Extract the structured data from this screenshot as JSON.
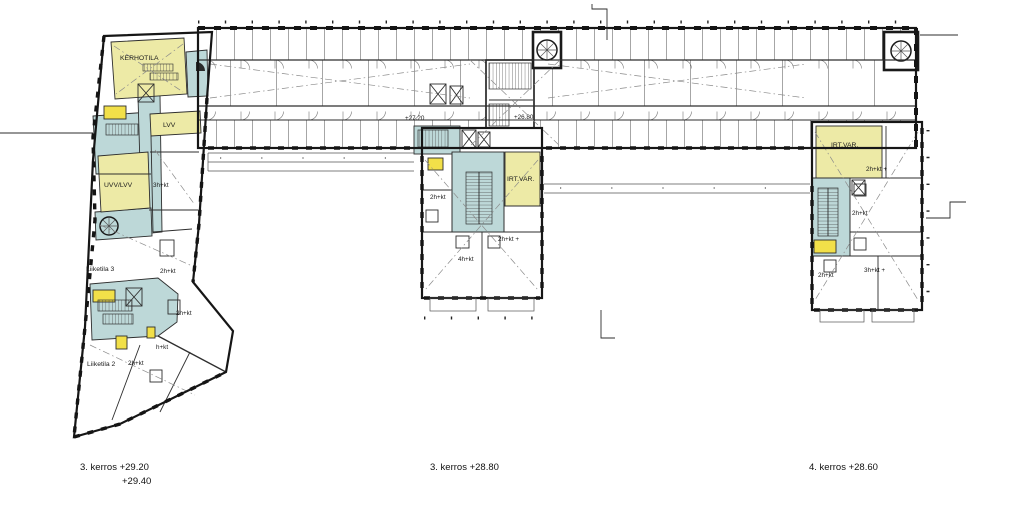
{
  "colors": {
    "paper": "#ffffff",
    "wall": "#161616",
    "thin_line": "#555555",
    "room_yellow": "#edeaa6",
    "room_blue": "#bdd8d8",
    "accent_yellow": "#f2e049"
  },
  "band": {
    "level_left": "+27.20",
    "level_right": "+26.80"
  },
  "left_wing": {
    "kerhotila": "KERHOTILA",
    "lvv": "LVV",
    "uvv_lvv": "UVV/LVV",
    "apt_3hkt": "3h+kt",
    "liiketila3": "Liiketila 3",
    "apt_2hkt_a": "2h+kt",
    "apt_2hkt_b": "2h+kt",
    "liiketila2": "Liiketila 2",
    "apt_2hkt_c": "2h+kt",
    "apt_hkt": "h+kt"
  },
  "middle_tower": {
    "irtvar": "IRT.VAR.",
    "apt_2hkt": "2h+kt",
    "apt_2hkt_plus": "2h+kt +",
    "apt_4hkt": "4h+kt"
  },
  "right_tower": {
    "irtvar": "IRT.VAR.",
    "apt_2hkt_plus": "2h+kt +",
    "apt_2hkt_a": "2h+kt",
    "apt_2hkt_b": "2h+kt",
    "apt_3hkt_plus": "3h+kt +"
  },
  "captions": {
    "left_line1": "3. kerros +29.20",
    "left_line2": "+29.40",
    "middle": "3. kerros +28.80",
    "right": "4. kerros +28.60"
  }
}
